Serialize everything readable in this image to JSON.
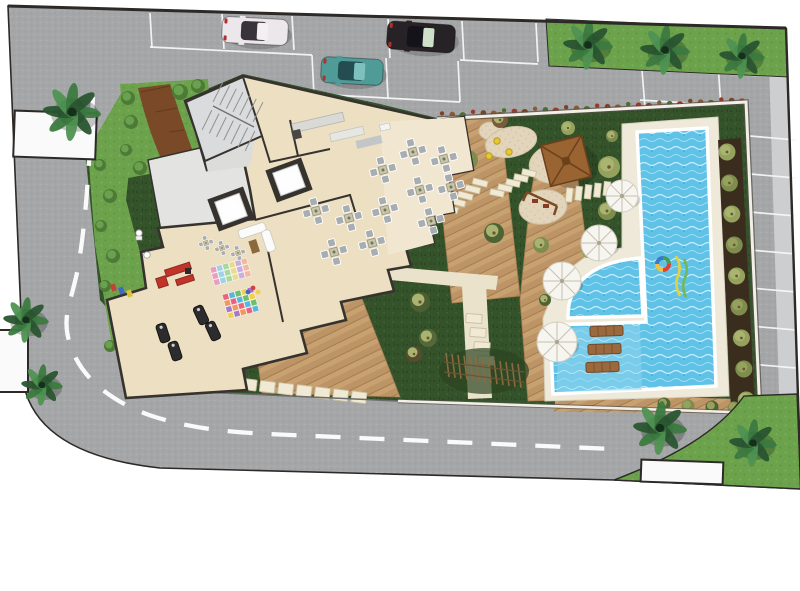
{
  "scene": {
    "description": "Architectural site plan of a residential complex: building floor plan with restaurant, gym and kids playroom, entrance plaza, parking lot with three cars, curved roads with dashed center lines, landscaped garden with playground, gazebo, pergola, white parasols, sun loungers and a large swimming pool with kids pool",
    "palette": {
      "asphalt": "#a5a6a8",
      "asphaltDot": "#9a9b9e",
      "asphaltLight": "#b2b3b5",
      "curb": "#cdced0",
      "boundary": "#2c2926",
      "lineWhite": "#f7f7f7",
      "grassDark": "#35532b",
      "grassDarkDot": "#2b4522",
      "grassBright": "#6ca24c",
      "grassBrightDot": "#7bb259",
      "wood": "#c8a171",
      "woodAlt": "#bd9465",
      "woodLine": "#a57c50",
      "woodPath": "#7a4a28",
      "woodPathLine": "#5e3519",
      "cream": "#eae2cb",
      "stone": "#f0e9d4",
      "stoneEdge": "#c9bfa2",
      "poolDeck": "#efe9da",
      "water": "#5fc2e6",
      "waterLight": "#c9eefa",
      "waterMid": "#9fdef4",
      "waterDark": "#35a5d4",
      "ledge": "#8fd6ee",
      "soil": "#3a2d1e",
      "floor": "#ecdfc2",
      "terrace": "#f1e7d1",
      "wall": "#36322e",
      "concrete": "#e3e3e1",
      "stair": "#d9dbdc",
      "lobby": "#dcdcda",
      "counter": "#d9d9d6",
      "chair": "#a7adb1",
      "chairEdge": "#ffffff",
      "tableTop": "#c9c4ae",
      "umbrella": "#f7f5f0",
      "umbrellaRib": "#c6c0b1",
      "sand": "#e2d5bc",
      "sandDot": "#d5c6a7",
      "sandEdge": "#cfc0a2",
      "roof": "#9a6332",
      "roofDark": "#6d401c",
      "lounger": "#9a6a3e",
      "loungerLine": "#74492a",
      "palmDark": "#2a5530",
      "palmMid": "#3c7a40",
      "palmLight": "#4f9252",
      "palmBase": "#1d3a22",
      "bushOlive": "#7e8d4e",
      "bushOlive2": "#95a25e",
      "bushGreen": "#4e7a38",
      "bushDark": "#4e6333",
      "planter": "#fafafa",
      "gymRed": "#c23428",
      "gymBlack": "#2c2c2e",
      "carWhite": "#ece7ea",
      "carBlack": "#272225",
      "carTeal": "#4f9b98",
      "shadow": "rgba(0,0,0,0.17)"
    },
    "inventory": {
      "cars": [
        {
          "name": "white-sedan",
          "body": "#ece7ea",
          "glass": "#39343c",
          "accent": "#f4f0f2"
        },
        {
          "name": "black-suv",
          "body": "#272225",
          "glass": "#15131a",
          "accent": "#cfe0c8"
        },
        {
          "name": "teal-car",
          "body": "#4f9b98",
          "glass": "#234d50",
          "accent": "#7ec0bd"
        }
      ],
      "umbrellas": 4,
      "sun_loungers": 3,
      "dining_tables": 11,
      "kids_tables": 3,
      "palm_clusters": 8,
      "pools": [
        "main-pool",
        "kids-pool"
      ],
      "amenities": [
        "parking",
        "stairwell",
        "elevators",
        "kitchen",
        "restaurant",
        "lounge",
        "gym",
        "kids-playroom",
        "entrance-plaza",
        "playground",
        "gazebo",
        "swing",
        "pergola",
        "sun-deck",
        "swimming-pool"
      ]
    }
  }
}
